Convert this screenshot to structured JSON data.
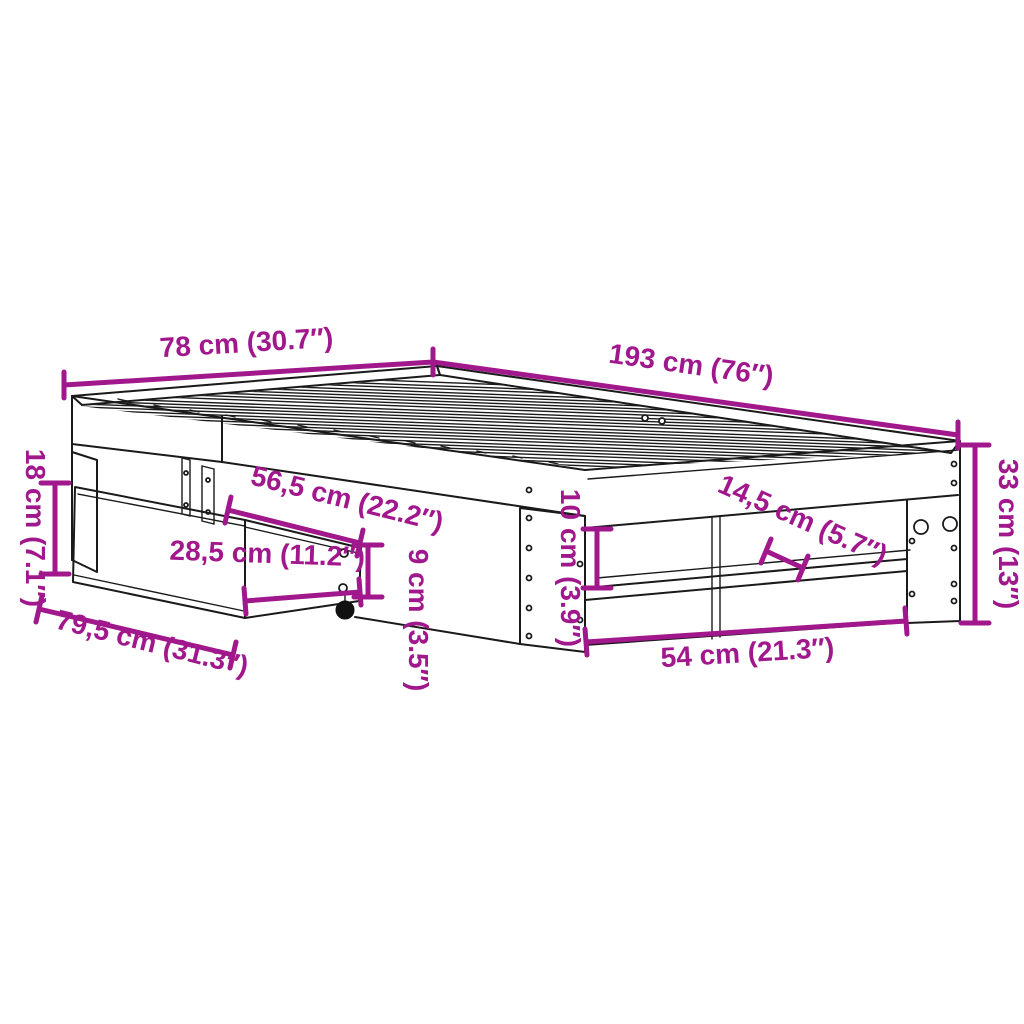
{
  "figure": {
    "type": "product-dimension-diagram",
    "subject": "bed-frame-with-drawer",
    "background_color": "#ffffff",
    "line_color": "#1a1a1a",
    "dimension_color": "#a1178c"
  },
  "dimensions": {
    "head_width": {
      "label": "78 cm (30.7″)",
      "value_cm": 78,
      "value_in": 30.7
    },
    "frame_length": {
      "label": "193 cm (76″)",
      "value_cm": 193,
      "value_in": 76
    },
    "drawer_front_height": {
      "label": "18 cm (7.1″)",
      "value_cm": 18,
      "value_in": 7.1
    },
    "drawer_top_depth": {
      "label": "56,5 cm (22.2″)",
      "value_cm": 56.5,
      "value_in": 22.2
    },
    "drawer_side_depth": {
      "label": "28,5 cm (11.2″)",
      "value_cm": 28.5,
      "value_in": 11.2
    },
    "drawer_front_width": {
      "label": "79,5 cm (31.3″)",
      "value_cm": 79.5,
      "value_in": 31.3
    },
    "drawer_side_height": {
      "label": "9 cm (3.5″)",
      "value_cm": 9,
      "value_in": 3.5
    },
    "shelf_gap_height": {
      "label": "10 cm (3.9″)",
      "value_cm": 10,
      "value_in": 3.9
    },
    "shelf_depth": {
      "label": "14,5 cm (5.7″)",
      "value_cm": 14.5,
      "value_in": 5.7
    },
    "opening_width": {
      "label": "54 cm (21.3″)",
      "value_cm": 54,
      "value_in": 21.3
    },
    "frame_height": {
      "label": "33 cm (13″)",
      "value_cm": 33,
      "value_in": 13
    }
  }
}
